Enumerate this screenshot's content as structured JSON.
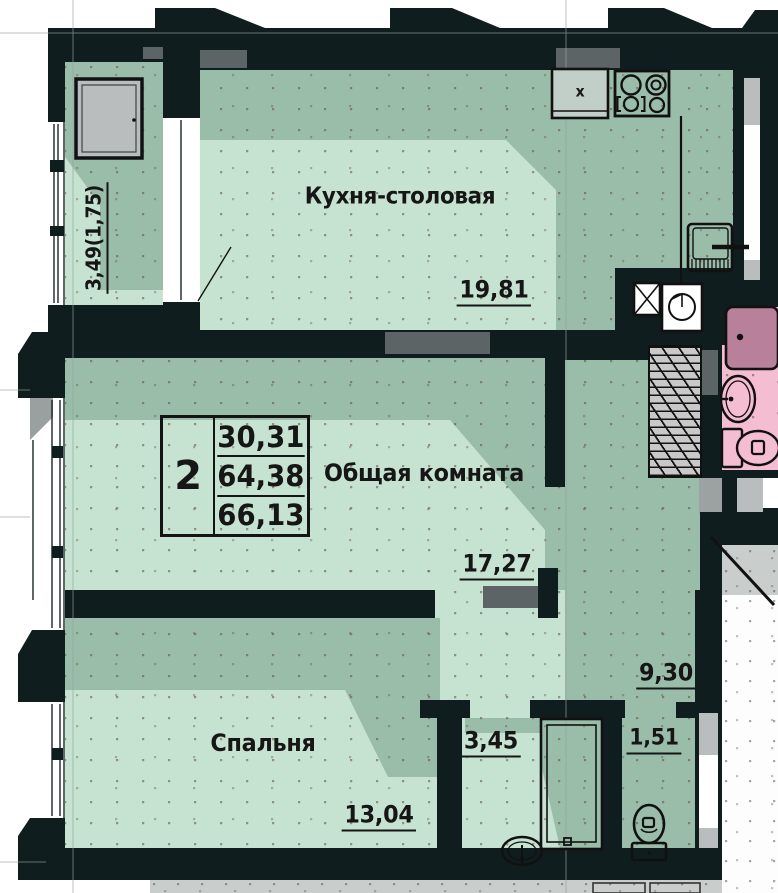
{
  "table": {
    "rooms_count": "2",
    "rows": [
      "30,31",
      "64,38",
      "66,13"
    ]
  },
  "labels": {
    "kitchen": "Кухня-столовая",
    "kitchen_area": "19,81",
    "living": "Общая комната",
    "living_area": "17,27",
    "bedroom": "Спальня",
    "bedroom_area": "13,04",
    "bathroom_area": "3,45",
    "wc_area": "1,51",
    "hall_area": "9,30",
    "balcony_area": "3,49(1,75)",
    "sink_mark": "x"
  },
  "colors": {
    "wall": "#101d1e",
    "light": "#c6e3d2",
    "dark": "#9abdaa",
    "pink": "#f5bdd2",
    "pinkdark": "#b9809b",
    "gray": "#5d6466",
    "win": "#b9bdbd",
    "landing": "#c9cdcb",
    "sink": "#c2cec8"
  }
}
